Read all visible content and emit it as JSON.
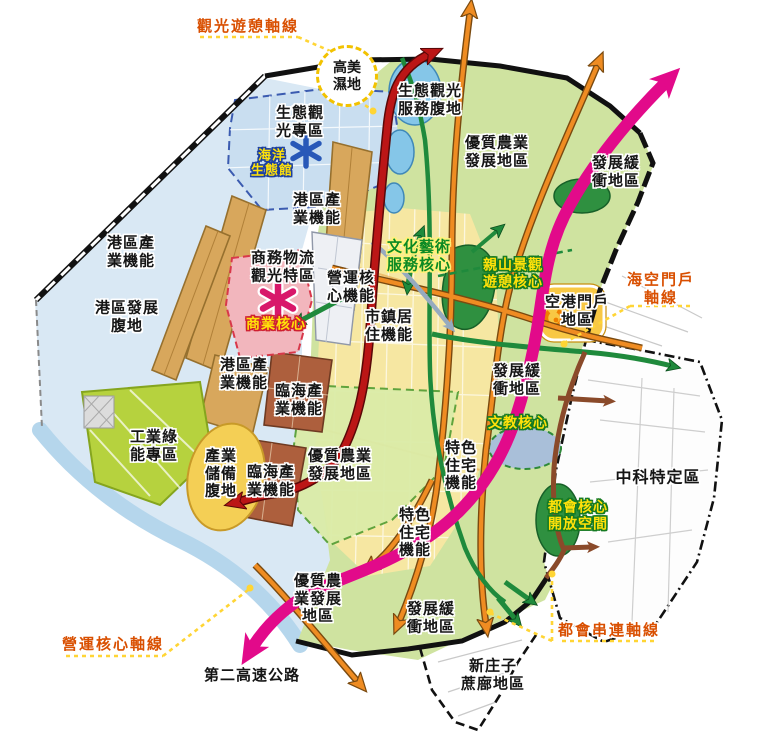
{
  "map": {
    "labels": {
      "axis_tourism": "觀光遊憩軸線",
      "gaomei_wetland": "高美\n濕地",
      "eco_service": "生態觀光\n服務腹地",
      "agri_top": "優質農業\n發展地區",
      "buffer_top": "發展緩\n衝地區",
      "eco_tourism_zone": "生態觀\n光專區",
      "marine_museum": "海洋\n生態館",
      "port_industry_1": "港區產\n業機能",
      "logistics_zone": "商務物流\n觀光特區",
      "operations_core_fn": "營運核\n心機能",
      "culture_core": "文化藝術\n服務核心",
      "mountain_core": "親山景觀\n遊憩核心",
      "port_industry_2": "港區產\n業機能",
      "port_dev": "港區發展\n腹地",
      "commerce_core": "商業核心",
      "town_residence": "市鎮居\n住機能",
      "axis_sea_air": "海空門戶\n軸線",
      "airport_gateway": "空港門戶\n地區",
      "port_industry_3": "港區產\n業機能",
      "coastal_industry_1": "臨海產\n業機能",
      "buffer_mid": "發展緩\n衝地區",
      "edu_core": "文教核心",
      "agri_mid": "優質農業\n發展地區",
      "residence_1": "特色\n住宅\n機能",
      "zhongke": "中科特定區",
      "industry_green": "工業綠\n能專區",
      "industry_reserve": "產業\n儲備\n腹地",
      "coastal_industry_2": "臨海產\n業機能",
      "metro_open_space": "都會核心\n開放空間",
      "residence_2": "特色\n住宅\n機能",
      "agri_bottom": "優質農\n業發展\n地區",
      "buffer_bottom": "發展緩\n衝地區",
      "axis_operations": "營運核心軸線",
      "highway2": "第二高速公路",
      "axis_metro": "都會串連軸線",
      "xinzhuangzi": "新庄子\n蔗廍地區"
    },
    "icons": {
      "marine_star": "✳",
      "commerce_star": "✳",
      "airport_ring": "◔"
    },
    "colors": {
      "axis_label": "#d94f00",
      "callout_yellow": "#ffd535",
      "magenta_axis": "#e20a8a",
      "red_axis": "#bb1616",
      "orange_road": "#ef8c22",
      "green_road": "#1f8a3c",
      "brown_road": "#8a4a2a",
      "steel_arrow": "#96aabf",
      "port_water": "#d9e8f4",
      "main_green": "#cfe3a0",
      "agri_green": "#dbeca8",
      "city_yellow": "#f6e7a2",
      "pier_tan": "#d8a75c",
      "coastal_brown": "#ad5f3d",
      "eco_blue": "#c9def0",
      "industry_green": "#b6d23e",
      "reserve_yellow": "#f4cf55",
      "pink_zone": "#f2b6bd",
      "park_green": "#2f9040",
      "gateway_yellow": "#f8c844",
      "lake_blue": "#85c6e8"
    }
  }
}
